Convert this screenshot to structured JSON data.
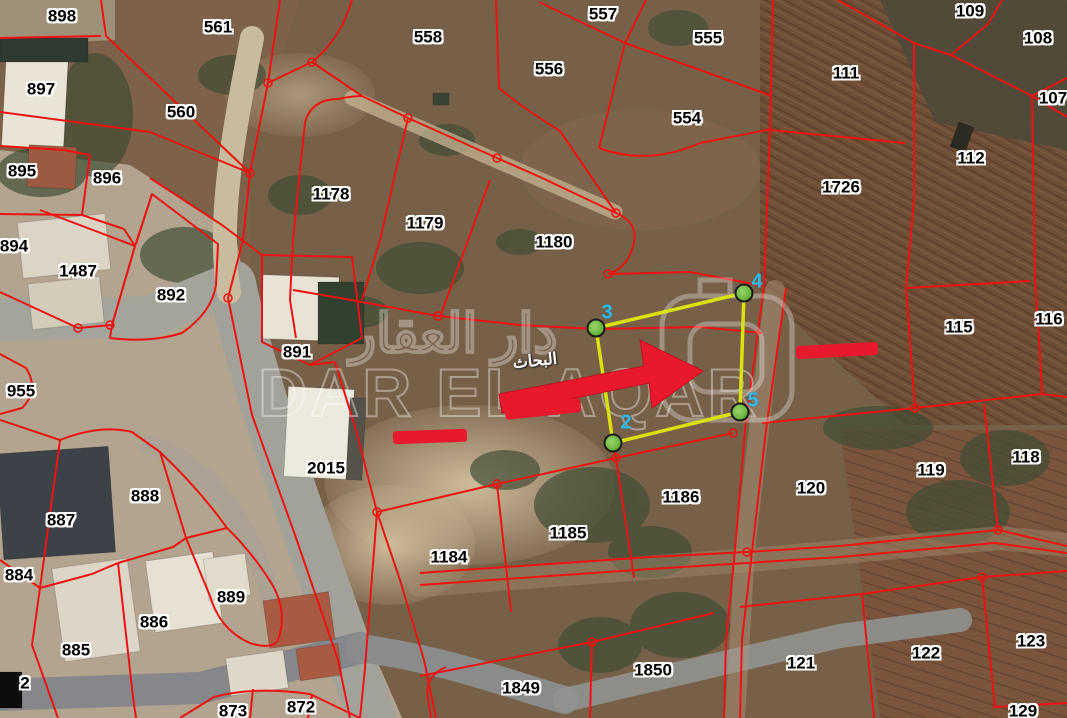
{
  "map": {
    "title": "cadastral-parcel-satellite-map",
    "region_label": {
      "text": "البحاث"
    },
    "watermark": {
      "latin": "DAR EL AQAR",
      "arabic": "دار العقار"
    },
    "colors": {
      "parcel_line": "#ee1212",
      "annotation_red": "#e8192c",
      "vertex_green": "#72c044",
      "vertex_number_cyan": "#35b9e9",
      "label_text": "#000000",
      "label_halo": "#ffffff",
      "highlight_yellow": "#d9e30b"
    },
    "parcel_labels": [
      {
        "id": "898",
        "x": 62,
        "y": 16
      },
      {
        "id": "561",
        "x": 218,
        "y": 27
      },
      {
        "id": "558",
        "x": 428,
        "y": 37
      },
      {
        "id": "557",
        "x": 603,
        "y": 14
      },
      {
        "id": "555",
        "x": 708,
        "y": 38
      },
      {
        "id": "556",
        "x": 549,
        "y": 69
      },
      {
        "id": "109",
        "x": 970,
        "y": 11
      },
      {
        "id": "108",
        "x": 1038,
        "y": 38
      },
      {
        "id": "897",
        "x": 41,
        "y": 89
      },
      {
        "id": "560",
        "x": 181,
        "y": 112
      },
      {
        "id": "554",
        "x": 687,
        "y": 118
      },
      {
        "id": "111",
        "x": 846,
        "y": 73
      },
      {
        "id": "107",
        "x": 1053,
        "y": 98
      },
      {
        "id": "895",
        "x": 22,
        "y": 171
      },
      {
        "id": "896",
        "x": 107,
        "y": 178
      },
      {
        "id": "112",
        "x": 971,
        "y": 158
      },
      {
        "id": "1726",
        "x": 841,
        "y": 187
      },
      {
        "id": "894",
        "x": 14,
        "y": 246
      },
      {
        "id": "1487",
        "x": 78,
        "y": 271
      },
      {
        "id": "892",
        "x": 171,
        "y": 295
      },
      {
        "id": "1178",
        "x": 331,
        "y": 194
      },
      {
        "id": "1179",
        "x": 425,
        "y": 223
      },
      {
        "id": "1180",
        "x": 554,
        "y": 242
      },
      {
        "id": "891",
        "x": 297,
        "y": 352
      },
      {
        "id": "115",
        "x": 959,
        "y": 327
      },
      {
        "id": "116",
        "x": 1049,
        "y": 319
      },
      {
        "id": "955",
        "x": 21,
        "y": 391
      },
      {
        "id": "2015",
        "x": 326,
        "y": 468
      },
      {
        "id": "888",
        "x": 145,
        "y": 496
      },
      {
        "id": "887",
        "x": 61,
        "y": 520
      },
      {
        "id": "884",
        "x": 19,
        "y": 575
      },
      {
        "id": "889",
        "x": 231,
        "y": 597
      },
      {
        "id": "886",
        "x": 154,
        "y": 622
      },
      {
        "id": "885",
        "x": 76,
        "y": 650
      },
      {
        "id": "873",
        "x": 233,
        "y": 711
      },
      {
        "id": "872",
        "x": 301,
        "y": 707
      },
      {
        "id": "1184",
        "x": 449,
        "y": 557
      },
      {
        "id": "1185",
        "x": 568,
        "y": 533
      },
      {
        "id": "1186",
        "x": 681,
        "y": 497
      },
      {
        "id": "120",
        "x": 811,
        "y": 488
      },
      {
        "id": "119",
        "x": 931,
        "y": 470
      },
      {
        "id": "118",
        "x": 1026,
        "y": 457
      },
      {
        "id": "121",
        "x": 801,
        "y": 663
      },
      {
        "id": "122",
        "x": 926,
        "y": 653
      },
      {
        "id": "123",
        "x": 1031,
        "y": 641
      },
      {
        "id": "129",
        "x": 1023,
        "y": 711
      },
      {
        "id": "1849",
        "x": 521,
        "y": 688
      },
      {
        "id": "1850",
        "x": 653,
        "y": 670
      }
    ],
    "partial_labels": [
      {
        "id": "2",
        "x": 25,
        "y": 683
      },
      {
        "id": "20",
        "x": 661,
        "y": 366
      }
    ],
    "highlight": {
      "polygon_points": "596,328 744,293 740,412 613,443",
      "vertices": [
        {
          "n": "2",
          "cx": 613,
          "cy": 443,
          "lx": 626,
          "ly": 423
        },
        {
          "n": "3",
          "cx": 596,
          "cy": 328,
          "lx": 607,
          "ly": 313
        },
        {
          "n": "4",
          "cx": 744,
          "cy": 293,
          "lx": 757,
          "ly": 282
        },
        {
          "n": "5",
          "cx": 740,
          "cy": 412,
          "lx": 753,
          "ly": 401
        }
      ]
    },
    "annotations": {
      "arrow_points": "499,394 644,366 640,340 703,371 652,408 649,383 502,413",
      "redaction_bars": [
        {
          "x": 837,
          "y": 350,
          "w": 82,
          "h": 13,
          "rot": -3
        },
        {
          "x": 543,
          "y": 409,
          "w": 76,
          "h": 14,
          "rot": -6
        },
        {
          "x": 430,
          "y": 436,
          "w": 74,
          "h": 13,
          "rot": -2
        }
      ]
    }
  }
}
